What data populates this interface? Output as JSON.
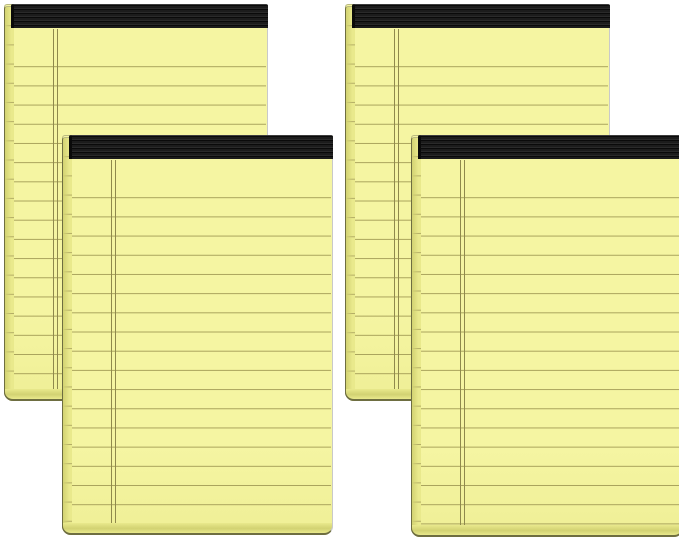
{
  "scene": {
    "description": "Product photo of four yellow legal note pads with black tape bindings, ruled lines and a double left margin line, shown as two overlapping pairs on a plain white background",
    "item_count": 4
  },
  "colors": {
    "background": "#FFFFFF",
    "paper": "#F5F5A2",
    "paper_shade": "#EFEF96",
    "rule_line": "#A9A35C",
    "margin_line": "#8F894C",
    "edge_strip": "#E9E98C",
    "edge_strip_dark": "#D2D272",
    "edge_notch": "#B4AE66",
    "outline_dark": "#6E6E41",
    "outline_soft": "#B9B980",
    "outline_gray": "#C9C9C9",
    "binding": "#1C1C1C",
    "binding_stripe": "#2A2A2A",
    "binding_edge": "#0A0A0A"
  },
  "ruling": {
    "line_spacing_px": 19.2,
    "ruling_top_px": 43,
    "binding_height_px": 24,
    "margin_line_left_px": 49,
    "left_edge_width_px": 10,
    "bottom_edge_height_px": 12
  },
  "pads": [
    {
      "id": "legal-pad-back-left",
      "left": 4,
      "top": 4,
      "width": 264,
      "height": 397,
      "layer": "back"
    },
    {
      "id": "legal-pad-back-right",
      "left": 345,
      "top": 4,
      "width": 265,
      "height": 397,
      "layer": "back"
    },
    {
      "id": "legal-pad-front-left",
      "left": 62,
      "top": 135,
      "width": 271,
      "height": 400,
      "layer": "front"
    },
    {
      "id": "legal-pad-front-right",
      "left": 411,
      "top": 135,
      "width": 272,
      "height": 402,
      "layer": "front"
    }
  ]
}
